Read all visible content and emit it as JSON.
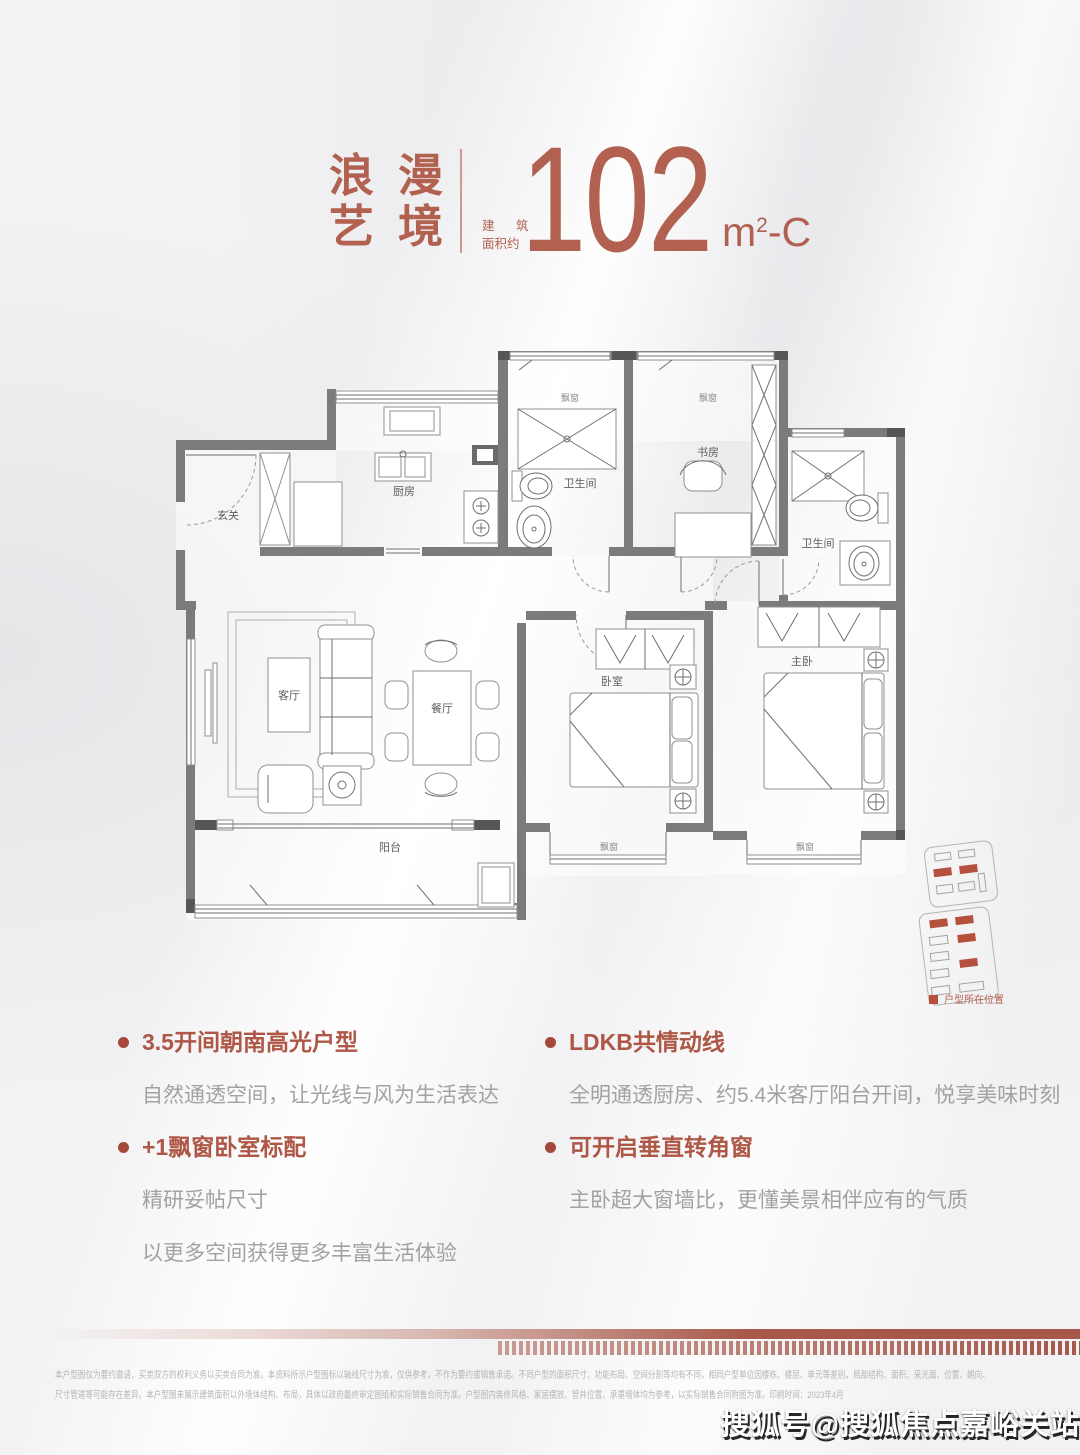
{
  "header": {
    "title_line1": "浪漫",
    "title_line2": "艺境",
    "area_label_line1": "建 筑",
    "area_label_line2": "面积约",
    "area_value": "102",
    "area_unit": "m",
    "area_exponent": "2",
    "area_suffix": "-C"
  },
  "floor_plan": {
    "rooms": {
      "entry": "玄关",
      "kitchen": "厨房",
      "bath": "卫生间",
      "study": "书房",
      "living": "客厅",
      "dining": "餐厅",
      "bedroom": "卧室",
      "master": "主卧",
      "balcony": "阳台",
      "bay_window": "飘窗"
    }
  },
  "site_plan": {
    "legend_label": "户型所在位置"
  },
  "features": {
    "left": [
      {
        "heading": "3.5开间朝南高光户型",
        "lines": [
          "自然通透空间，让光线与风为生活表达"
        ]
      },
      {
        "heading": "+1飘窗卧室标配",
        "lines": [
          "精研妥帖尺寸",
          "以更多空间获得更多丰富生活体验"
        ]
      }
    ],
    "right": [
      {
        "heading": "LDKB共情动线",
        "lines": [
          "全明通透厨房、约5.4米客厅阳台开间，悦享美味时刻"
        ]
      },
      {
        "heading": "可开启垂直转角窗",
        "lines": [
          "主卧超大窗墙比，更懂美景相伴应有的气质"
        ]
      }
    ]
  },
  "disclaimer": {
    "line1": "本户型图仅为要约邀请，买卖双方的权利义务以买卖合同为准。本资料所示户型图标以轴线尺寸为准，仅供参考，不作为要约或销售承诺。不同户型的面积尺寸、功能布局、空间分割等均有不同，相同户型单位因楼栋、楼层、单元等差别，局部结构、面积、采光面、位置、朝向、",
    "line2": "尺寸管道等可能存在差异。本户型图未展示建筑面积以外墙体结构、布局，具体以政府最终审定图纸和实际销售合同为准。户型图内装修风格、家居摆放、管井位置、承重墙体均为参考，以实际销售合同附图为准。印刷时间：2023年4月"
  },
  "watermark": "搜狐号@搜狐焦点嘉峪关站",
  "colors": {
    "accent": "#b2604f",
    "accent_heading": "#ae5746",
    "accent_dot": "#a64839",
    "highlight": "#b5503c",
    "bar": "#a5574a",
    "wall": "#7b7b7b"
  }
}
